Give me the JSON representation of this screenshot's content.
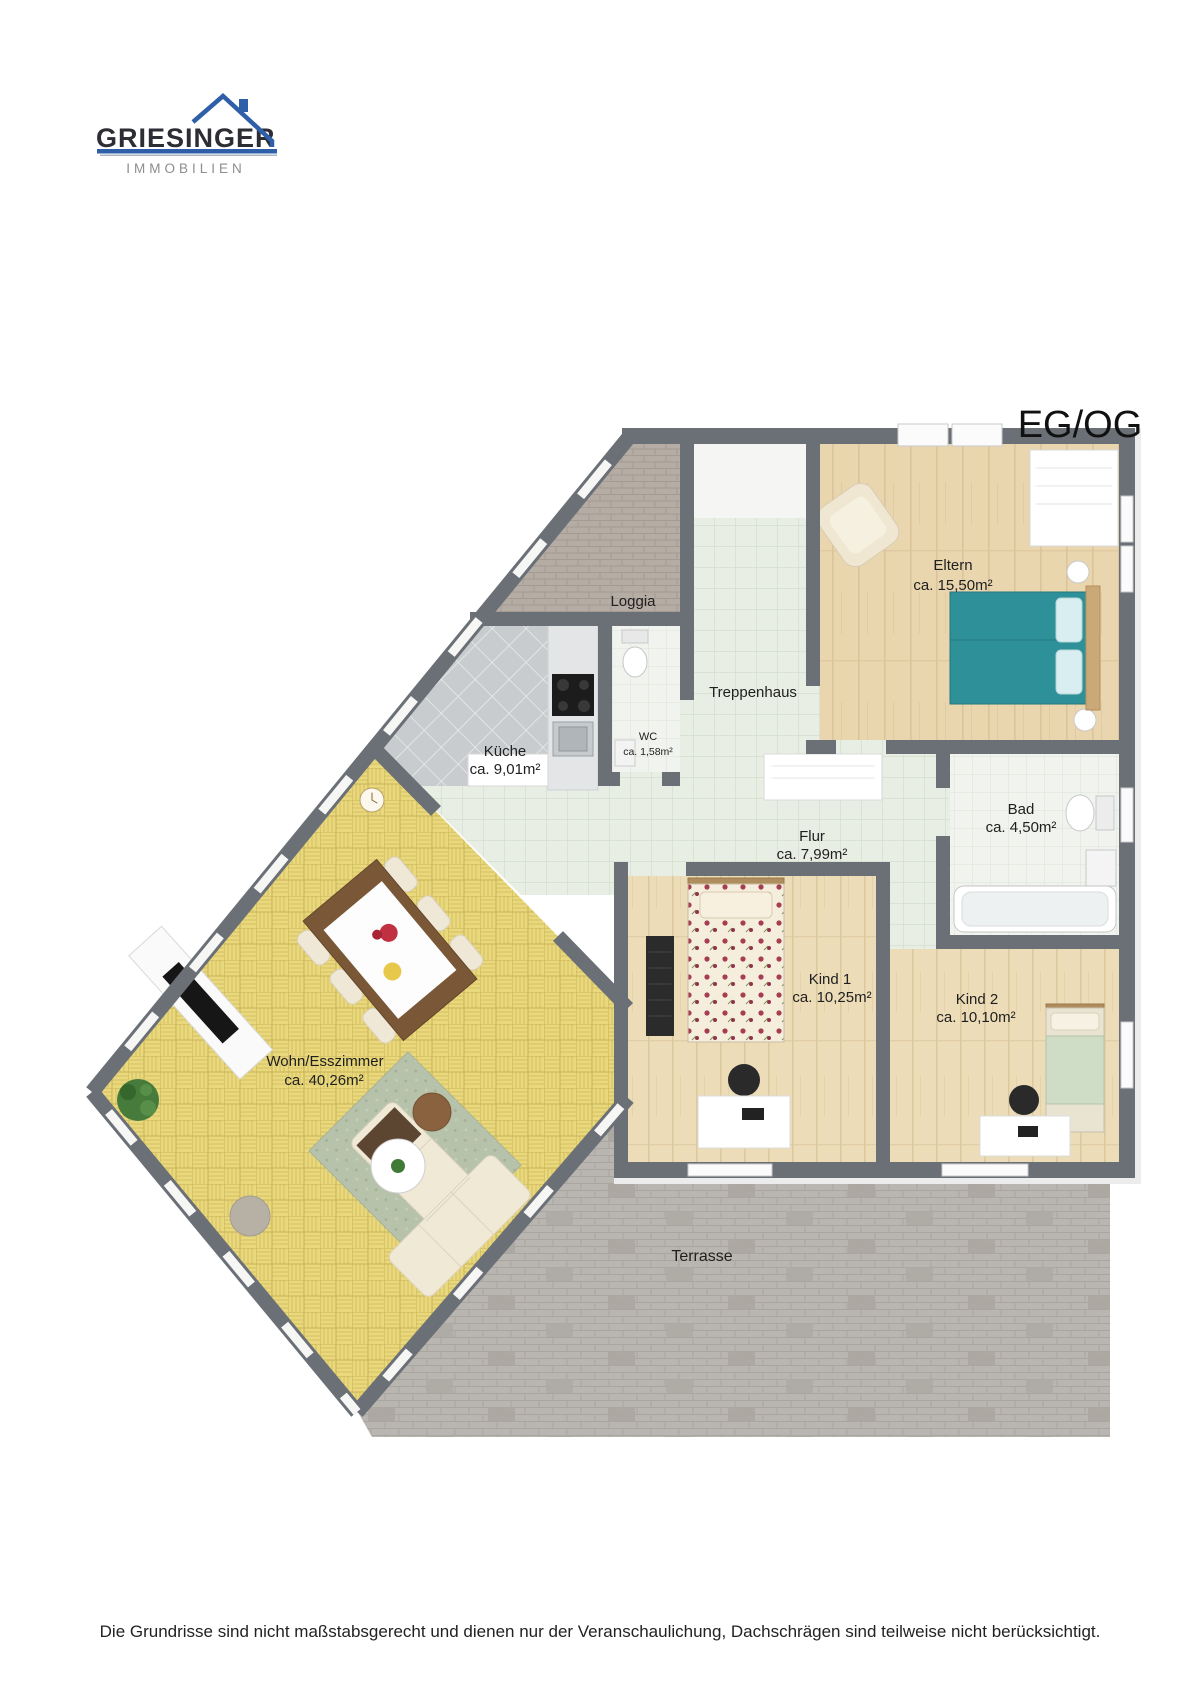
{
  "header": {
    "logo_name": "GRIESINGER",
    "logo_subtitle": "IMMOBILIEN",
    "plan_title": "EG/OG"
  },
  "rooms": [
    {
      "name": "Loggia",
      "area": ""
    },
    {
      "name": "Treppenhaus",
      "area": ""
    },
    {
      "name": "Eltern",
      "area": "ca. 15,50m²"
    },
    {
      "name": "Küche",
      "area": "ca. 9,01m²"
    },
    {
      "name": "WC",
      "area": "ca. 1,58m²"
    },
    {
      "name": "Flur",
      "area": "ca. 7,99m²"
    },
    {
      "name": "Bad",
      "area": "ca. 4,50m²"
    },
    {
      "name": "Kind 1",
      "area": "ca. 10,25m²"
    },
    {
      "name": "Kind 2",
      "area": "ca. 10,10m²"
    },
    {
      "name": "Wohn/Esszimmer",
      "area": "ca. 40,26m²"
    },
    {
      "name": "Terrasse",
      "area": ""
    }
  ],
  "footer": {
    "disclaimer": "Die Grundrisse sind nicht maßstabsgerecht und dienen nur der Veranschaulichung, Dachschrägen sind teilweise nicht berücksichtigt."
  },
  "colors": {
    "logo_blue": "#2f5fa8",
    "wall_gray": "#6b7077",
    "parquet_yellow": "#e9d87c",
    "wood_floor": "#e9d6af",
    "bed_teal": "#2e9098",
    "terrace_gray": "#b9b6b1"
  }
}
